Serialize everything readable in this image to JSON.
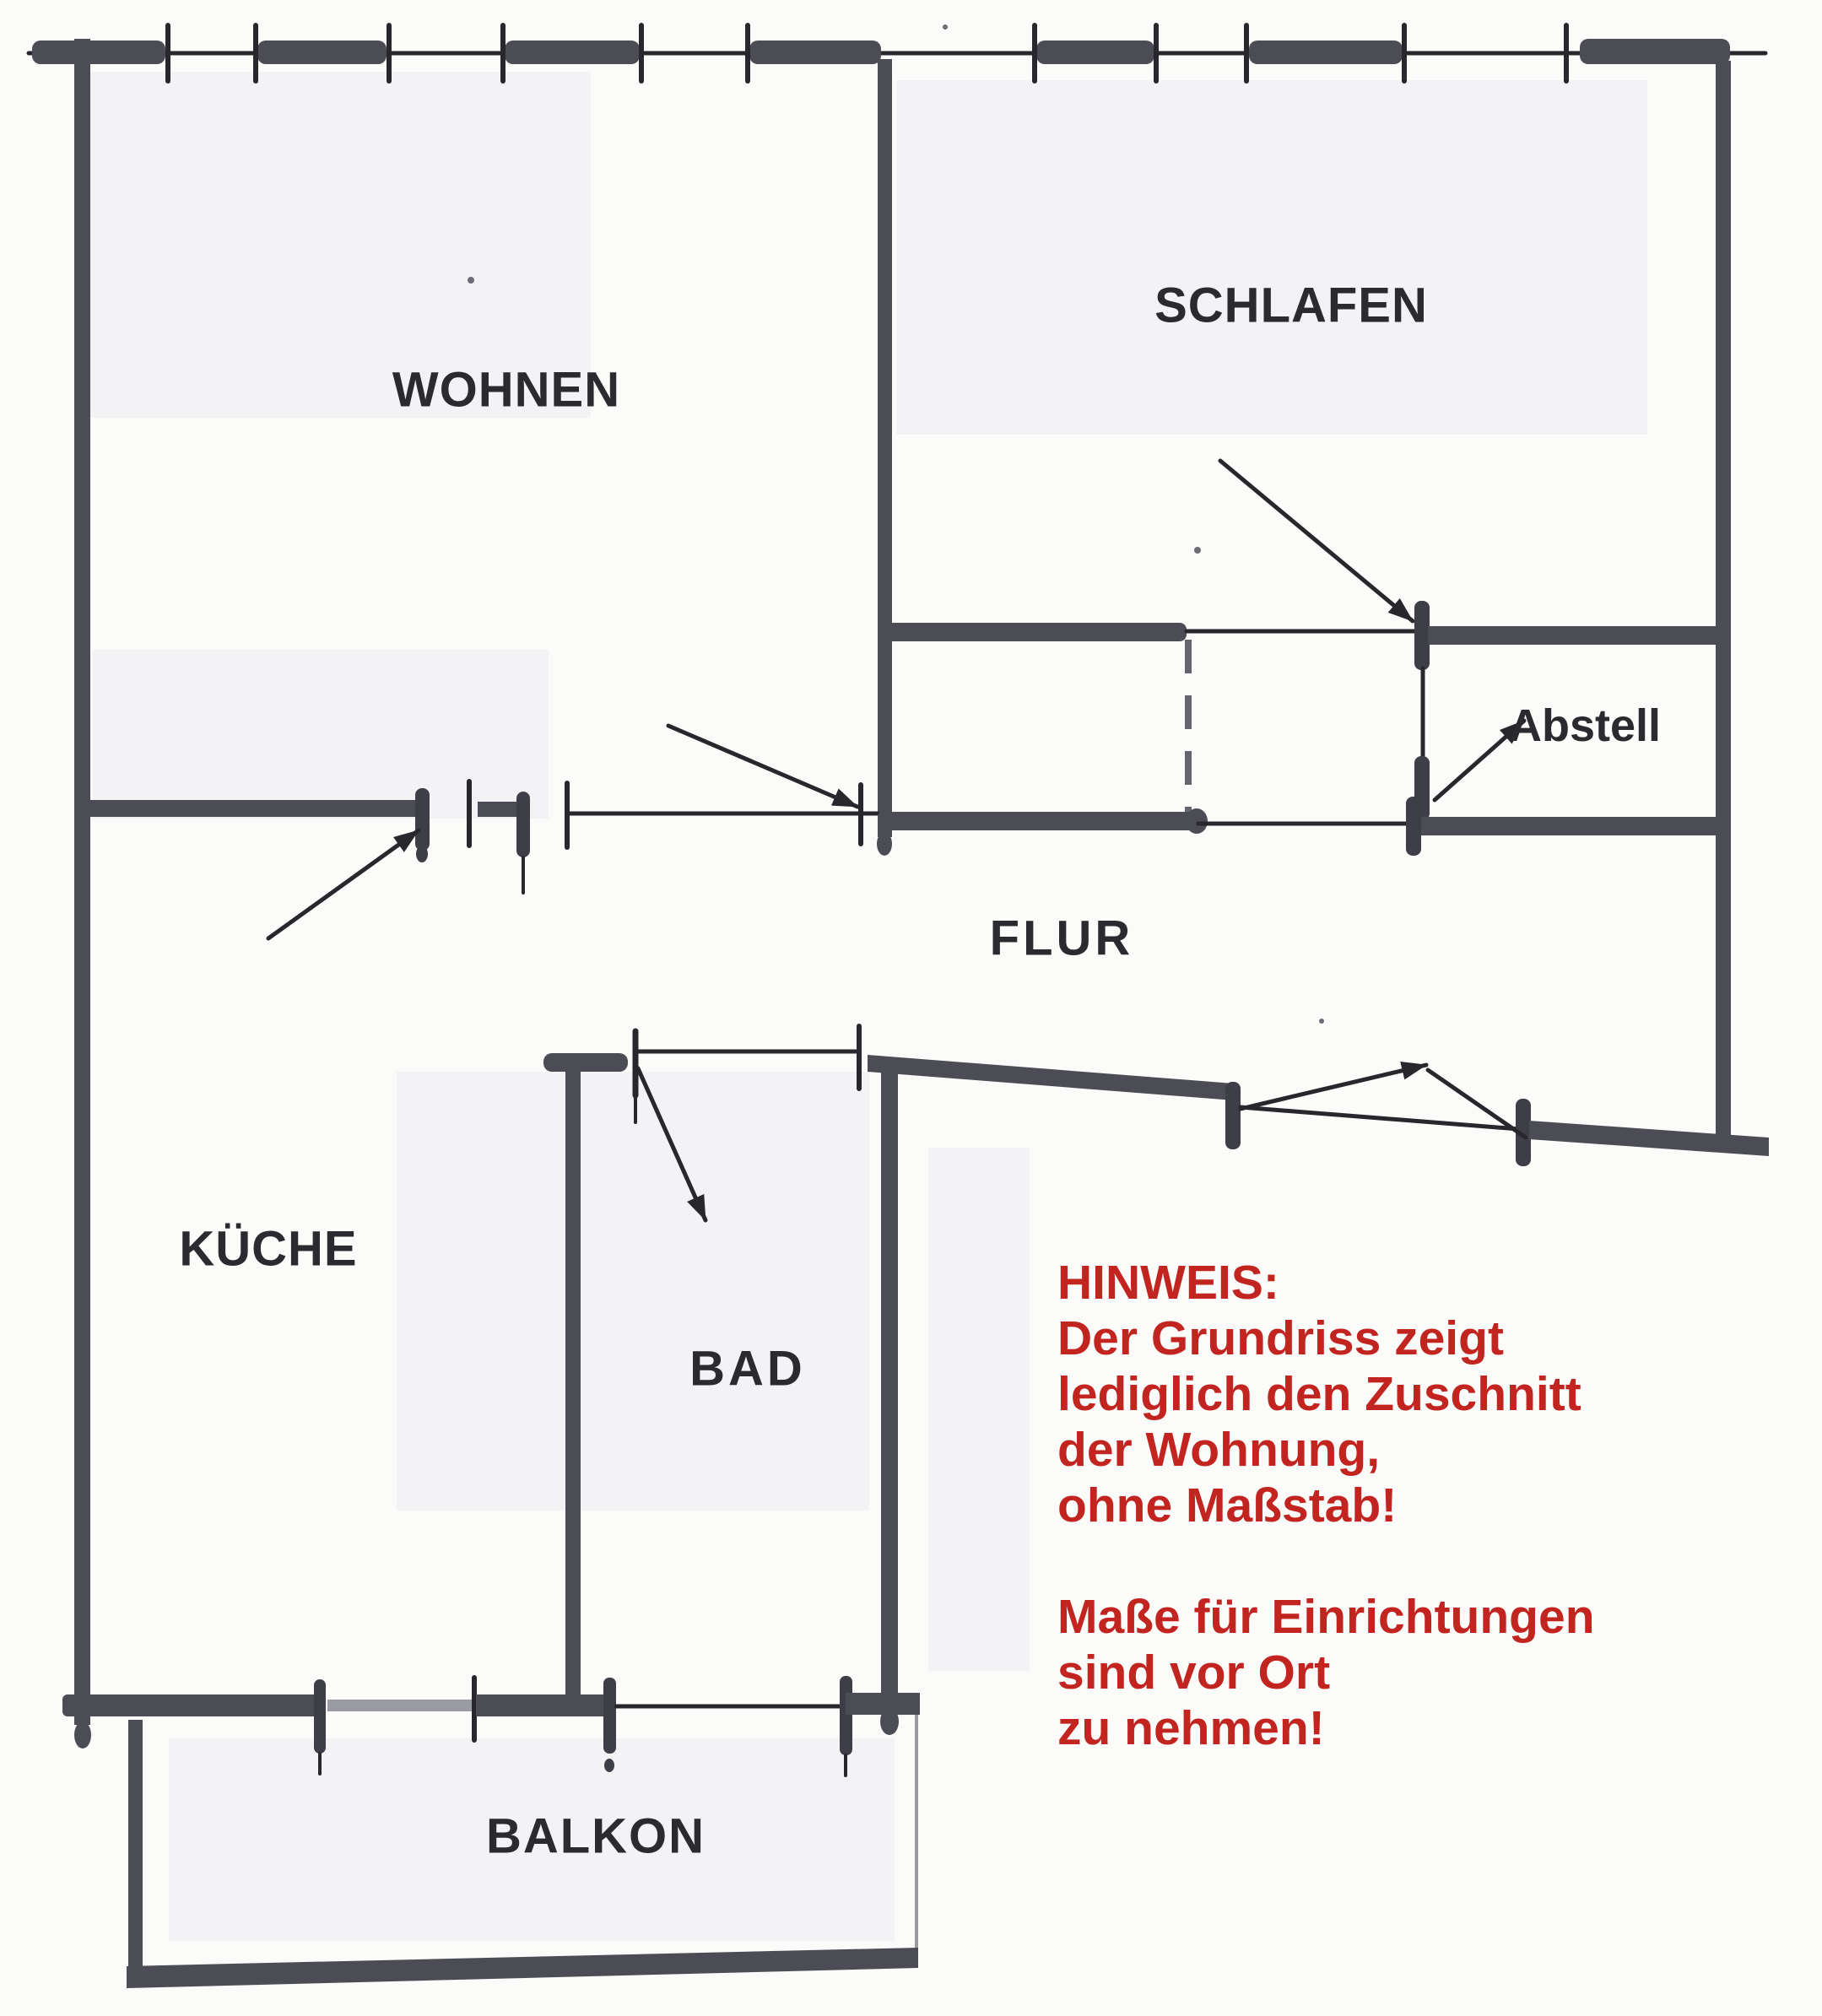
{
  "document": {
    "kind": "hand-drawn apartment floor plan (scanned sketch)"
  },
  "colors": {
    "background": "#fbfbfa",
    "shade": "#f3f3f5",
    "wall": "#4c4c55",
    "wall_dark": "#3e3e47",
    "wall_light": "#9a9aa2",
    "line": "#27272c",
    "label": "#2b2b2f",
    "accent_red": "#c22420"
  },
  "rooms": [
    {
      "id": "wohnen",
      "label": "WOHNEN"
    },
    {
      "id": "schlafen",
      "label": "SCHLAFEN"
    },
    {
      "id": "abstell",
      "label": "Abstell"
    },
    {
      "id": "flur",
      "label": "FLUR"
    },
    {
      "id": "kueche",
      "label": "KÜCHE"
    },
    {
      "id": "bad",
      "label": "BAD"
    },
    {
      "id": "balkon",
      "label": "BALKON"
    }
  ],
  "note": {
    "lines": [
      "HINWEIS:",
      "Der Grundriss zeigt",
      "lediglich den Zuschnitt",
      "der Wohnung,",
      "ohne Maßstab!",
      "Maße für Einrichtungen",
      "sind vor Ort",
      "zu nehmen!"
    ]
  }
}
